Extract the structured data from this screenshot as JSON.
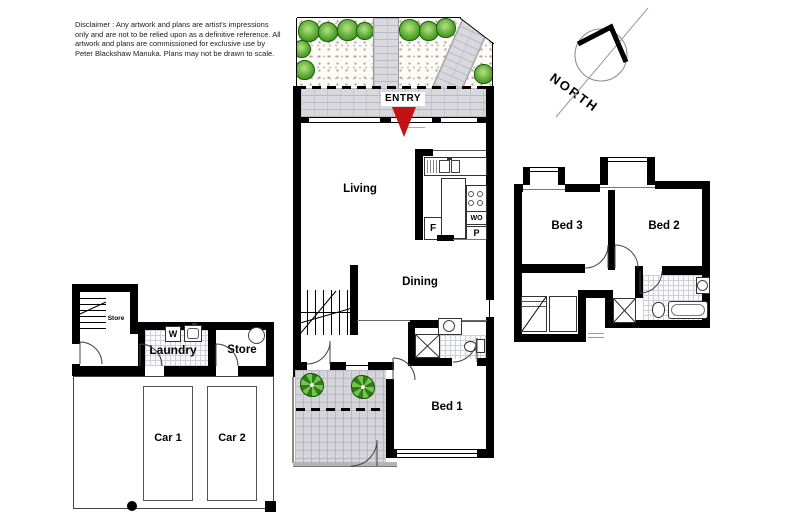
{
  "disclaimer": {
    "lines": [
      "Disclaimer : Any artwork and plans are artist's impressions",
      "only and are not to be relied upon as a definitive reference. All",
      "artwork and plans are commissioned for exclusive use by",
      "Peter Blackshaw Manuka. Plans may not be drawn to scale."
    ]
  },
  "compass": {
    "label": "NORTH"
  },
  "entry": {
    "label": "ENTRY"
  },
  "rooms": {
    "living": "Living",
    "dining": "Dining",
    "bed1": "Bed 1",
    "bed2": "Bed 2",
    "bed3": "Bed 3",
    "laundry": "Laundry",
    "store_upper": "Store",
    "store": "Store",
    "car1": "Car 1",
    "car2": "Car 2"
  },
  "kitchen": {
    "fridge": "F",
    "wall_oven": "WO",
    "pantry": "P"
  },
  "laundry_fixtures": {
    "washer": "W"
  },
  "colors": {
    "wall": "#000000",
    "paving": "#d8d8dd",
    "plant_fill": "#5aab31",
    "plant_edge": "#1c5c0d",
    "entry_arrow": "#c41111"
  }
}
